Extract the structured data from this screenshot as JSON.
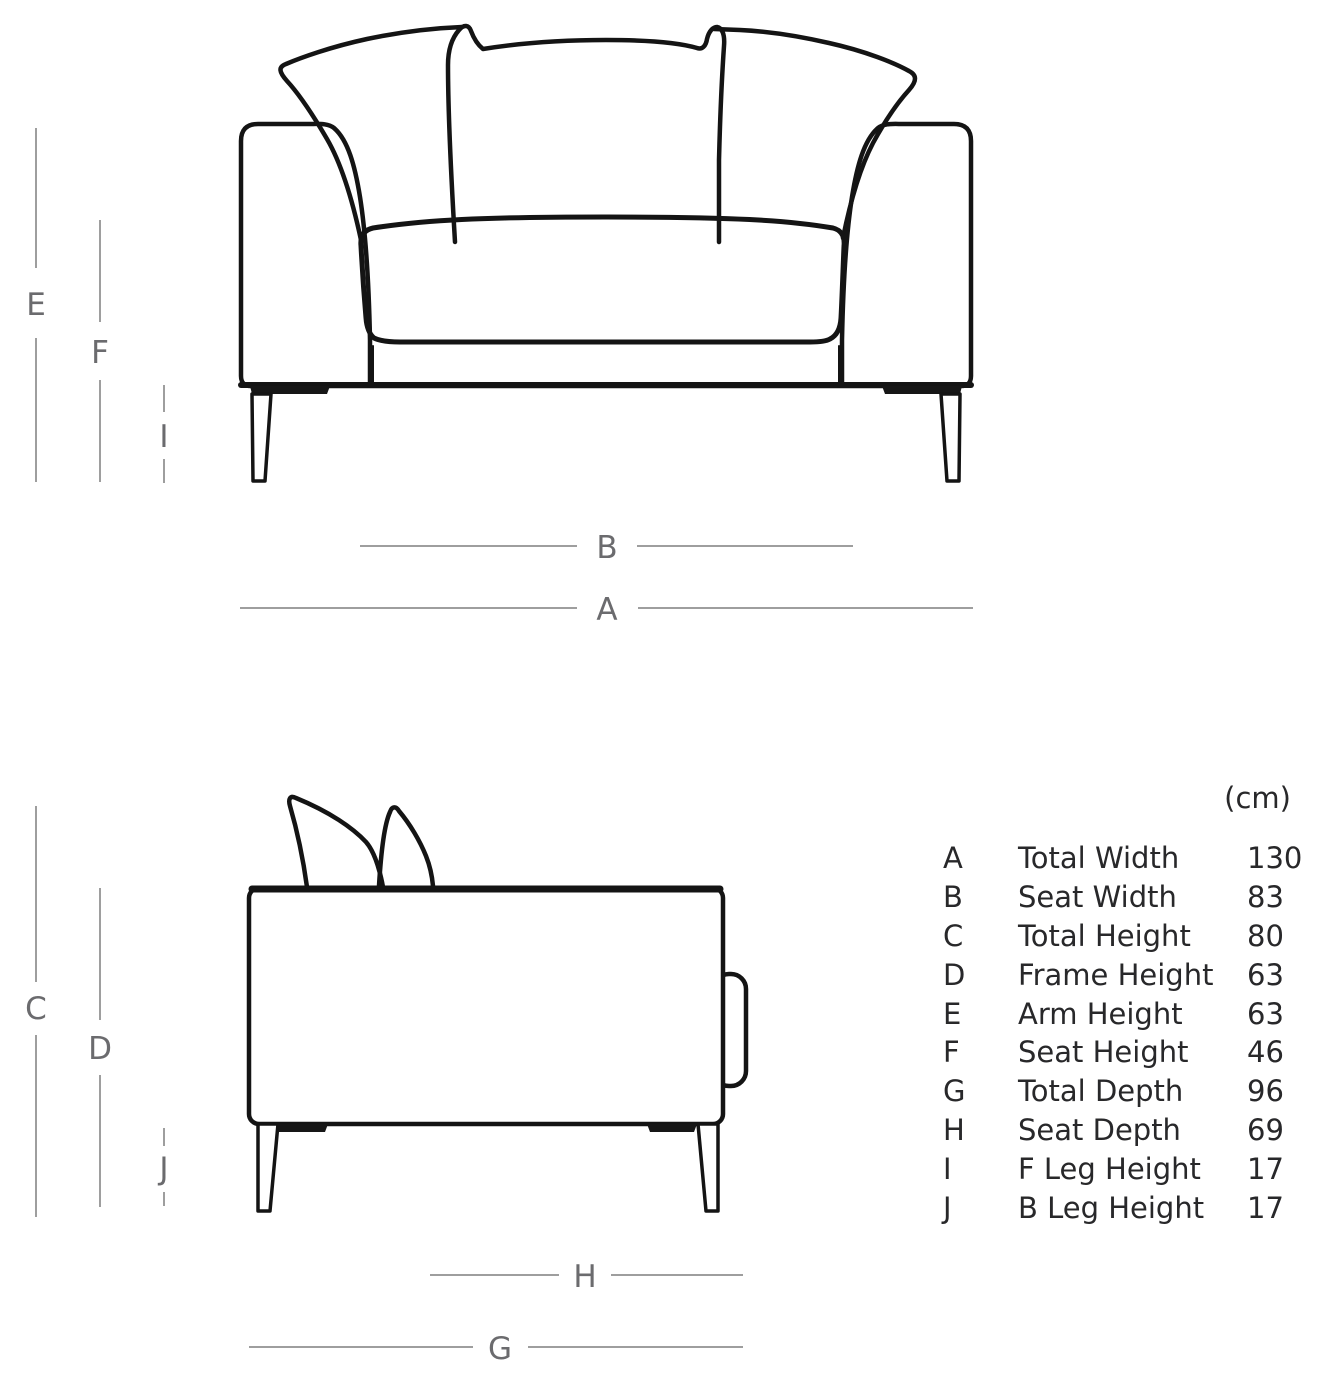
{
  "diagram": {
    "front_view": {
      "vertical_labels": [
        "E",
        "F",
        "I"
      ],
      "horizontal_labels": [
        "B",
        "A"
      ]
    },
    "side_view": {
      "vertical_labels": [
        "C",
        "D",
        "J"
      ],
      "horizontal_labels": [
        "H",
        "G"
      ]
    }
  },
  "table": {
    "unit": "(cm)",
    "rows": [
      {
        "key": "A",
        "label": "Total Width",
        "value": "130"
      },
      {
        "key": "B",
        "label": "Seat Width",
        "value": "83"
      },
      {
        "key": "C",
        "label": "Total Height",
        "value": "80"
      },
      {
        "key": "D",
        "label": "Frame Height",
        "value": "63"
      },
      {
        "key": "E",
        "label": "Arm Height",
        "value": "63"
      },
      {
        "key": "F",
        "label": "Seat Height",
        "value": "46"
      },
      {
        "key": "G",
        "label": "Total Depth",
        "value": "96"
      },
      {
        "key": "H",
        "label": "Seat Depth",
        "value": "69"
      },
      {
        "key": "I",
        "label": "F Leg Height",
        "value": "17"
      },
      {
        "key": "J",
        "label": "B Leg Height",
        "value": "17"
      }
    ]
  }
}
